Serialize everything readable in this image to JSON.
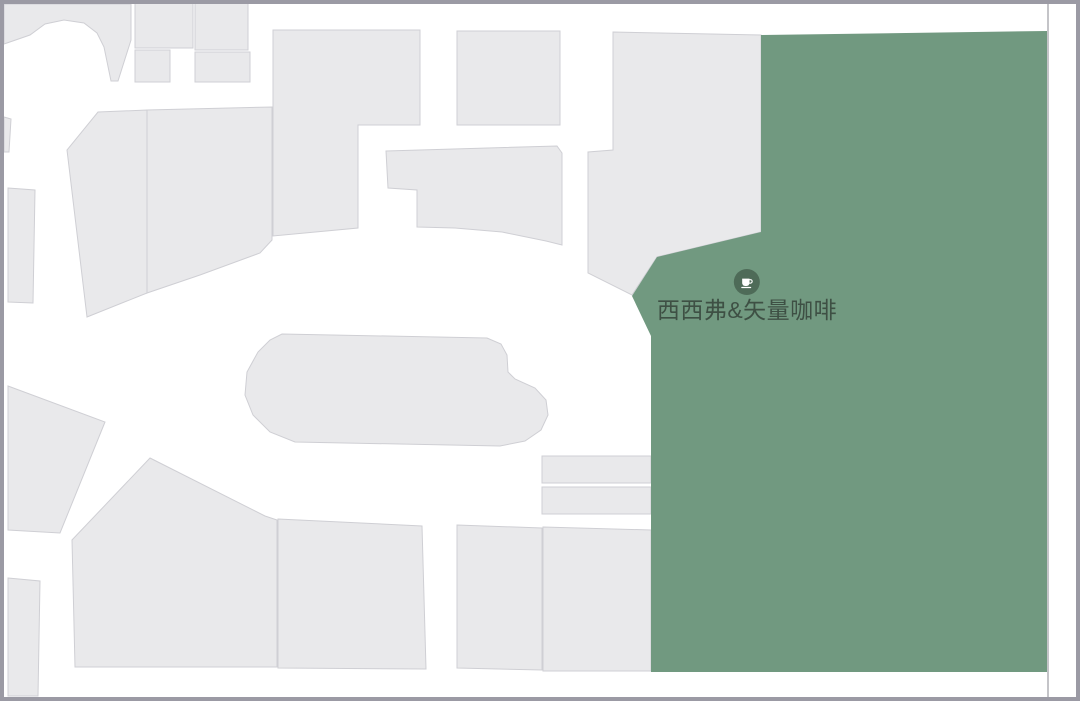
{
  "map": {
    "highlighted_store": {
      "label": "西西弗&矢量咖啡",
      "icon": "coffee-cup"
    },
    "colors": {
      "bg": "#ffffff",
      "frame": "#9b9aa4",
      "store-fill": "#e9e9eb",
      "store-stroke": "#cfcfd4",
      "green": "#719980",
      "icon-green": "#4e6b58",
      "label": "#3e5044",
      "boundary": "#b0b0b6"
    },
    "boundary_line": {
      "name": "map-boundary-line",
      "points": "1048,4 1048,697"
    },
    "shapes": [
      {
        "name": "mall-unit-top-left-block",
        "role": "unit",
        "interactable": false,
        "points": "4,4 131,4 131,40 118,81 111,81 104,47 97,33 84,23 64,20 45,24 30,35 4,44"
      },
      {
        "name": "mall-unit-left-sliver",
        "role": "unit",
        "interactable": false,
        "points": "4,117 11,119 9,152 4,152"
      },
      {
        "name": "mall-unit-top-a",
        "role": "unit",
        "interactable": false,
        "points": "135,3 193,3 193,48 135,48"
      },
      {
        "name": "mall-unit-top-b",
        "role": "unit",
        "interactable": false,
        "points": "135,50 170,50 170,82 135,82"
      },
      {
        "name": "mall-unit-top-c",
        "role": "unit",
        "interactable": false,
        "points": "195,2 248,2 248,50 195,50"
      },
      {
        "name": "mall-unit-top-d",
        "role": "unit",
        "interactable": false,
        "points": "195,52 250,52 250,82 195,82"
      },
      {
        "name": "mall-unit-top-e",
        "role": "unit",
        "interactable": false,
        "points": "273,30 420,30 420,125 358,125 358,228 273,236"
      },
      {
        "name": "mall-unit-top-square",
        "role": "unit",
        "interactable": false,
        "points": "457,31 560,31 560,125 457,125"
      },
      {
        "name": "mall-unit-mid-left-a",
        "role": "unit",
        "interactable": false,
        "points": "98,112 147,110 147,293 87,317 67,150"
      },
      {
        "name": "mall-unit-mid-left-b",
        "role": "unit",
        "interactable": false,
        "points": "147,110 272,107 272,240 260,253 200,275 147,293"
      },
      {
        "name": "mall-unit-left-column",
        "role": "unit",
        "interactable": false,
        "points": "8,188 35,190 33,303 8,302"
      },
      {
        "name": "mall-unit-mid-band",
        "role": "unit",
        "interactable": false,
        "points": "386,151 557,146 562,153 562,245 546,241 502,232 455,228 417,227 417,190 388,188"
      },
      {
        "name": "mall-unit-right-slab",
        "role": "unit",
        "interactable": false,
        "points": "613,32 761,35 761,232 657,257 632,295 588,273 588,152 613,150"
      },
      {
        "name": "mall-unit-center-island",
        "role": "unit",
        "interactable": false,
        "points": "282,334 487,338 501,344 507,355 508,372 515,379 535,388 546,400 548,415 541,430 525,441 500,446 295,442 270,432 253,415 245,395 247,372 258,352 270,340"
      },
      {
        "name": "mall-unit-bottom-left-a",
        "role": "unit",
        "interactable": false,
        "points": "8,386 105,422 60,533 8,530"
      },
      {
        "name": "mall-unit-bottom-left-b",
        "role": "unit",
        "interactable": false,
        "points": "150,458 265,516 277,520 277,667 75,667 72,540"
      },
      {
        "name": "mall-unit-bottom-c",
        "role": "unit",
        "interactable": false,
        "points": "278,519 422,526 426,669 278,668"
      },
      {
        "name": "mall-unit-bottom-d",
        "role": "unit",
        "interactable": false,
        "points": "457,525 542,528 542,670 457,668"
      },
      {
        "name": "mall-unit-bottom-e",
        "role": "unit",
        "interactable": false,
        "points": "543,527 651,530 651,671 543,671"
      },
      {
        "name": "mall-unit-kiosk-a",
        "role": "unit",
        "interactable": false,
        "points": "542,456 651,456 651,483 542,483"
      },
      {
        "name": "mall-unit-kiosk-b",
        "role": "unit",
        "interactable": false,
        "points": "542,487 651,487 651,514 542,514"
      },
      {
        "name": "mall-unit-bottom-left-strip",
        "role": "unit",
        "interactable": false,
        "points": "8,578 40,581 38,696 8,696"
      },
      {
        "name": "highlighted-store-region",
        "role": "highlight",
        "interactable": true,
        "points": "761,35 1047,31 1047,672 651,672 651,336 632,296 657,257 761,232"
      }
    ]
  }
}
